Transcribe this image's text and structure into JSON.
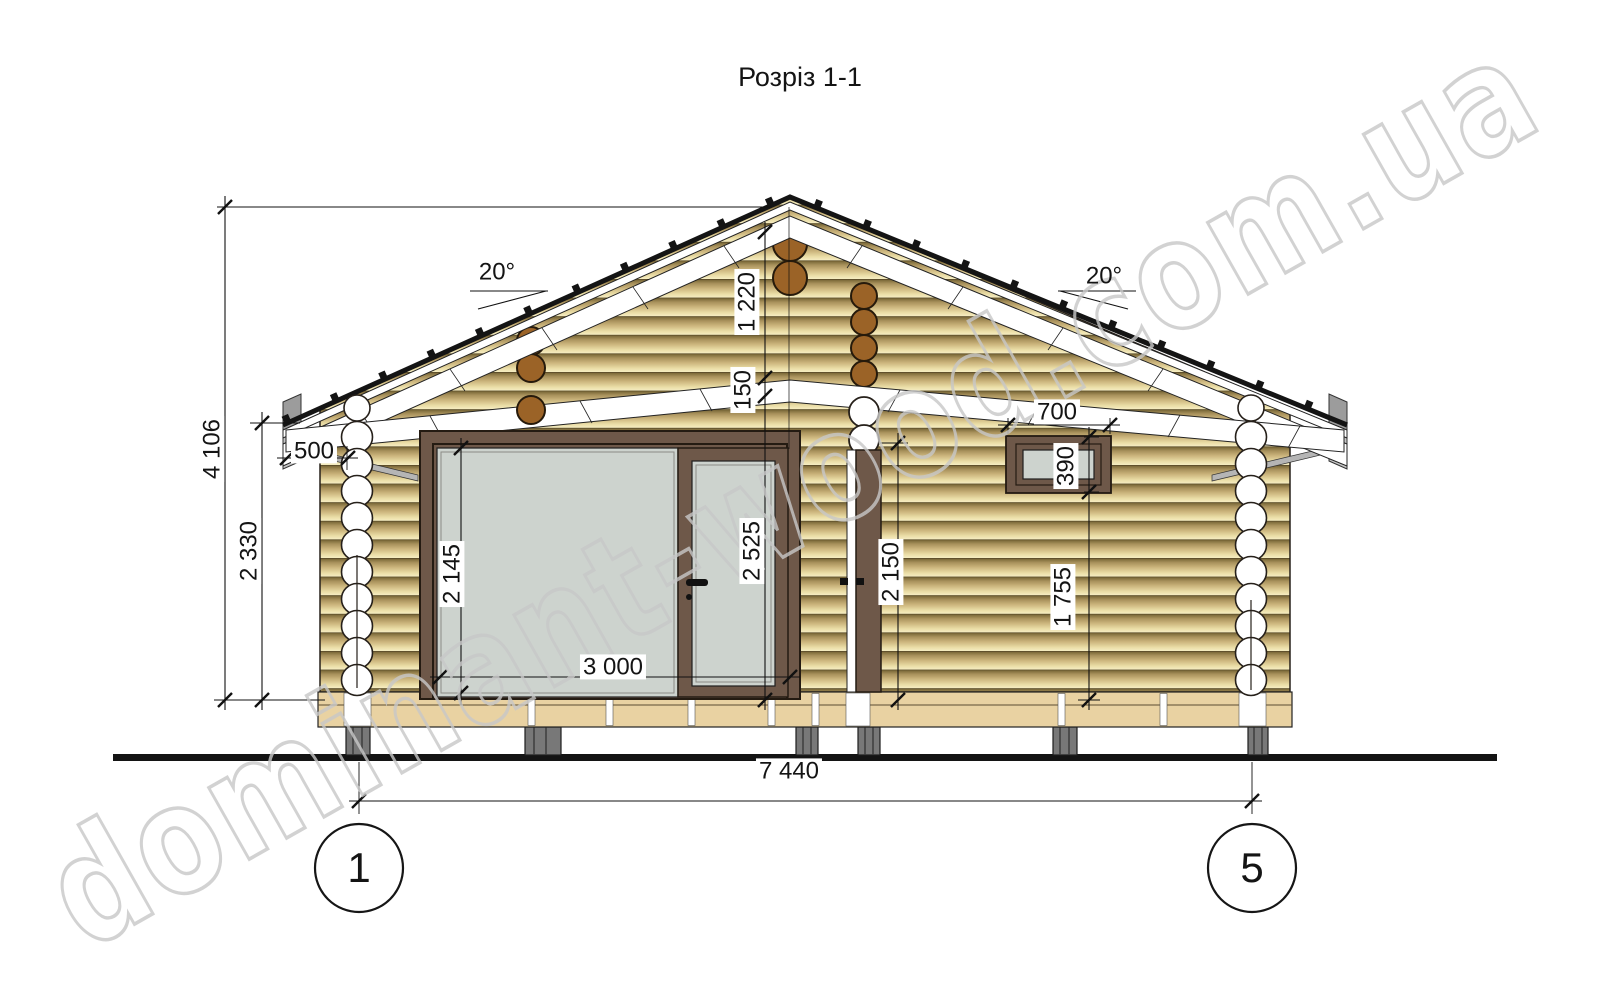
{
  "title": "Розріз 1-1",
  "watermark": "dominant-wood.com.ua",
  "axes": {
    "left_label": "1",
    "right_label": "5"
  },
  "dimensions": {
    "total_height": "4 106",
    "wall_height": "2 330",
    "roof_overhang": "500",
    "roof_angle_left": "20°",
    "roof_angle_right": "20°",
    "ridge_to_ceiling": "1 220",
    "ceiling_beam": "150",
    "glazing_height": "2 145",
    "door_unit_height": "2 525",
    "door_unit_width": "3 000",
    "inner_door_height": "2 150",
    "window_width": "700",
    "window_height": "390",
    "window_sill_height": "1 755",
    "axis_span": "7 440"
  },
  "colors": {
    "log_light": "#f6edc2",
    "log_dark": "#7a6838",
    "frame_brown": "#6e5849",
    "glass": "#cdd3ce",
    "purlin_brown": "#9b6327",
    "pile_gray": "#787878",
    "watermark_gray": "#c8c8c8"
  }
}
